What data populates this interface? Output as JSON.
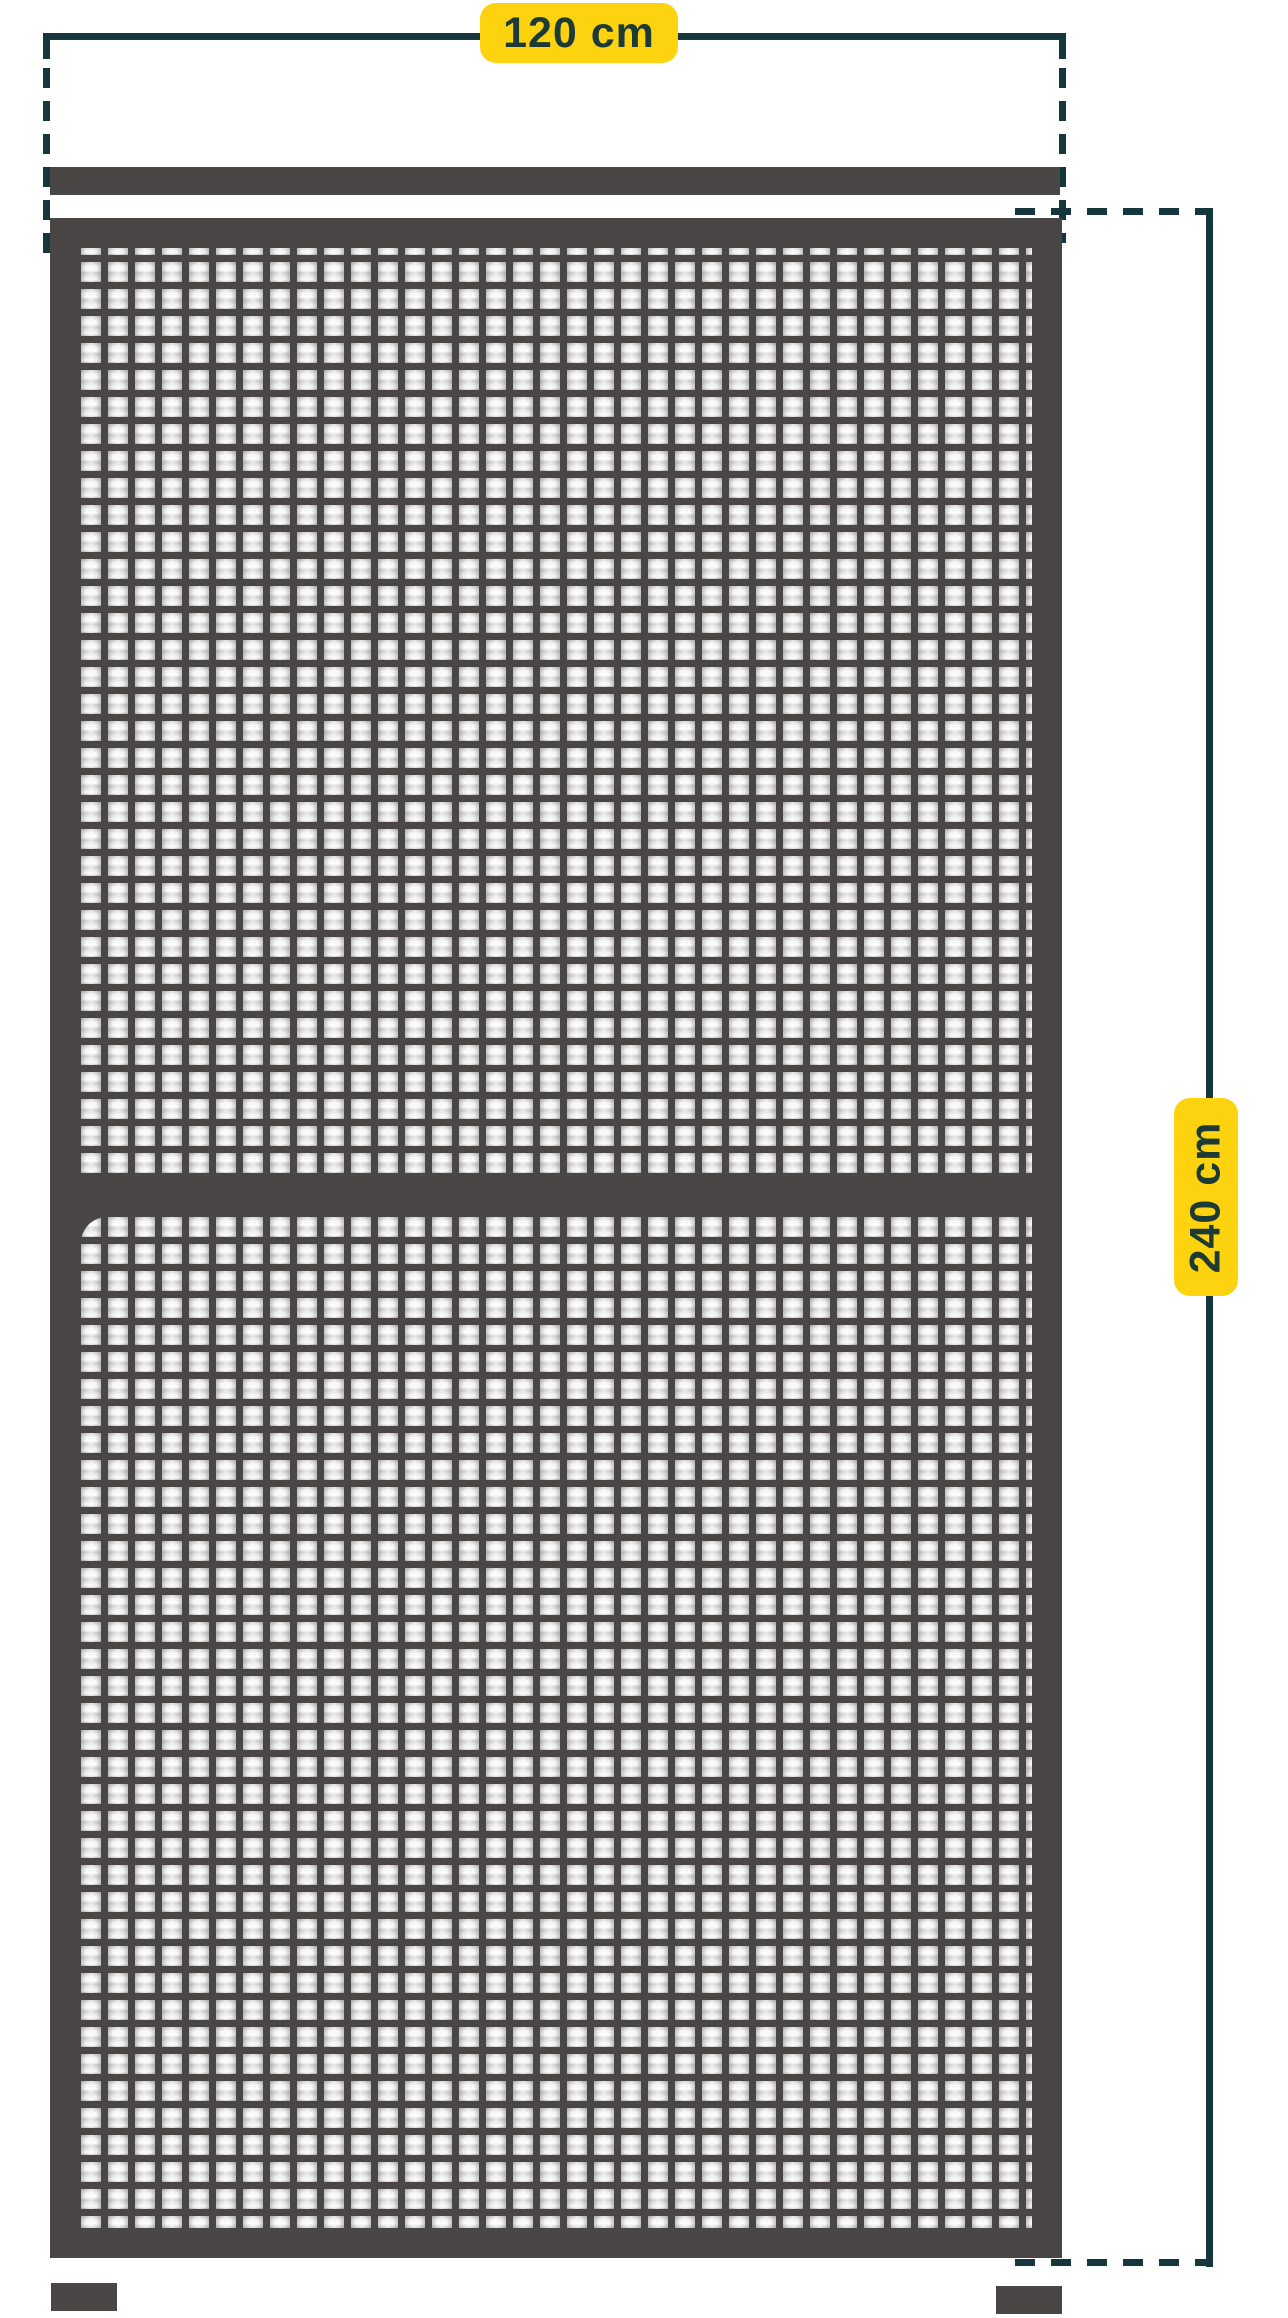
{
  "diagram": {
    "product": "insect-screen-door-dimension-diagram",
    "width_dimension": {
      "value": 120,
      "unit": "cm",
      "label": "120 cm"
    },
    "height_dimension": {
      "value": 240,
      "unit": "cm",
      "label": "240 cm"
    }
  },
  "theme": {
    "dimension_line_color": "#14363c",
    "label_bg_color": "#fdd20e",
    "label_text_color": "#1c3a36",
    "frame_color": "#4a4645",
    "background_color": "#ffffff"
  }
}
